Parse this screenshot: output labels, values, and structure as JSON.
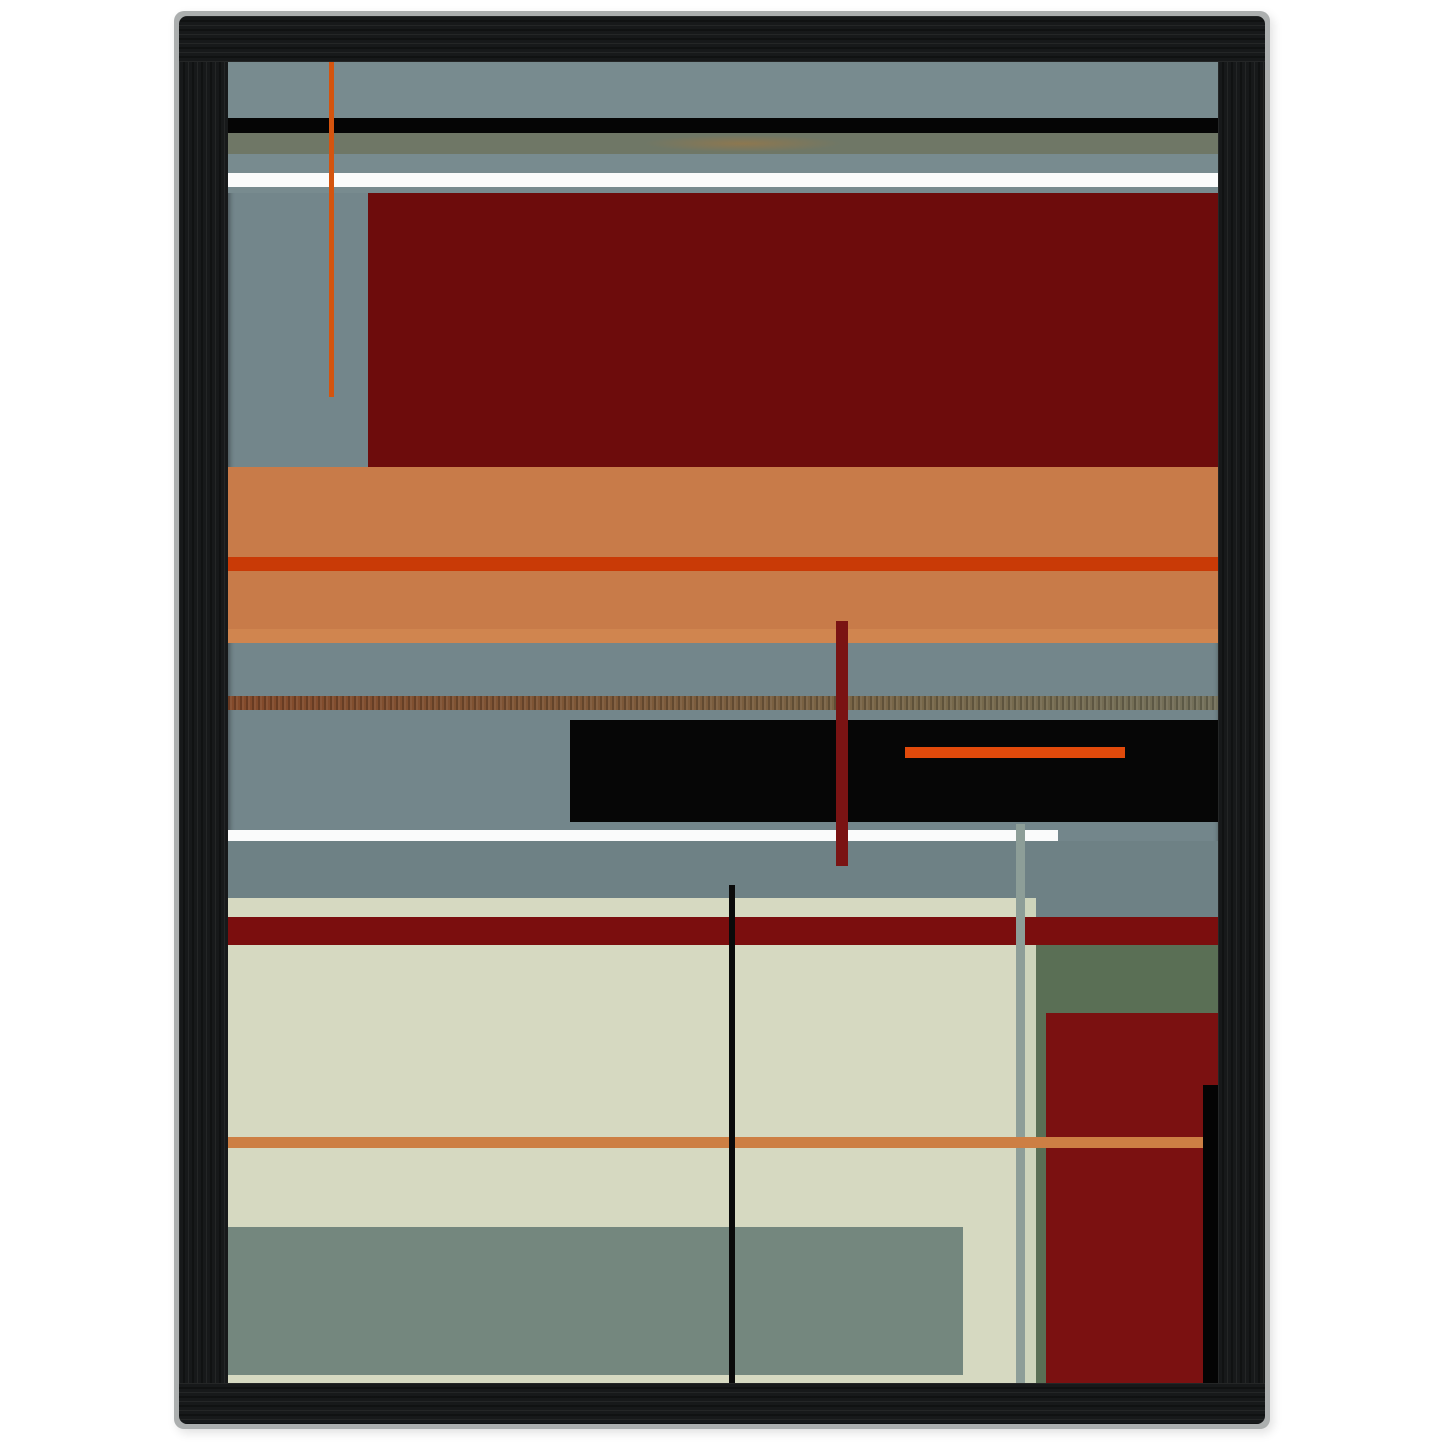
{
  "scene": {
    "background_color": "#ffffff"
  },
  "frame": {
    "rim": {
      "x": 174,
      "y": 11,
      "w": 1096,
      "h": 1418,
      "color": "#acafaf",
      "radius": 10
    },
    "wood": {
      "x": 179,
      "y": 16,
      "w": 1086,
      "h": 1408,
      "color": "#17191a",
      "radius": 8
    },
    "opening": {
      "x": 228,
      "y": 62,
      "w": 990,
      "h": 1321
    }
  },
  "artwork": {
    "base_color": "#73868b",
    "shapes": [
      {
        "name": "gray-top-area",
        "x": 0,
        "y": 0,
        "w": 990,
        "h": 131,
        "bg": "#788b8f"
      },
      {
        "name": "black-stripe-top",
        "x": 0,
        "y": 56,
        "w": 990,
        "h": 15,
        "bg": "#050505"
      },
      {
        "name": "olive-stripe",
        "x": 0,
        "y": 71,
        "w": 990,
        "h": 21,
        "bg": "radial-gradient(ellipse 140px 12px at 52% 50%, rgba(190,120,42,0.38), rgba(190,120,42,0) 70%), #6f7766"
      },
      {
        "name": "white-stripe-top",
        "x": 0,
        "y": 111,
        "w": 990,
        "h": 14,
        "bg": "#fafbfb"
      },
      {
        "name": "dark-red-rect-top",
        "x": 140,
        "y": 131,
        "w": 850,
        "h": 274,
        "bg": "#6d0c0c"
      },
      {
        "name": "orange-band",
        "x": 0,
        "y": 405,
        "w": 990,
        "h": 176,
        "bg": "#c87b49"
      },
      {
        "name": "orange-band-red-stripe",
        "x": 0,
        "y": 495,
        "w": 990,
        "h": 14,
        "bg": "#c93a06"
      },
      {
        "name": "orange-band-light-strip",
        "x": 0,
        "y": 567,
        "w": 990,
        "h": 14,
        "bg": "#d0854f"
      },
      {
        "name": "textured-brown-stripe",
        "x": 0,
        "y": 634,
        "w": 990,
        "h": 14,
        "bg": "repeating-linear-gradient(90deg, rgba(0,0,0,0.20) 0px, rgba(0,0,0,0.20) 2px, rgba(255,255,255,0.06) 2px, rgba(255,255,255,0.06) 4px, rgba(0,0,0,0) 4px, rgba(0,0,0,0) 6px), linear-gradient(90deg, #83492a 0%, #7d5636 35%, #776749 70%, #73705a 100%)"
      },
      {
        "name": "black-rect-middle",
        "x": 342,
        "y": 658,
        "w": 648,
        "h": 102,
        "bg": "#060606"
      },
      {
        "name": "orange-red-bar",
        "x": 677,
        "y": 685,
        "w": 220,
        "h": 11,
        "bg": "#e14a0b"
      },
      {
        "name": "white-stripe-middle",
        "x": 0,
        "y": 768,
        "w": 830,
        "h": 11,
        "bg": "#fafbfb"
      },
      {
        "name": "gray-band-lower",
        "x": 0,
        "y": 779,
        "w": 990,
        "h": 76,
        "bg": "#6e8185"
      },
      {
        "name": "cream-block",
        "x": 0,
        "y": 836,
        "w": 788,
        "h": 485,
        "bg": "#d6d9c1"
      },
      {
        "name": "cream-strip-right",
        "x": 797,
        "y": 836,
        "w": 11,
        "h": 485,
        "bg": "#cdd4bb"
      },
      {
        "name": "olive-green-region",
        "x": 808,
        "y": 883,
        "w": 182,
        "h": 68,
        "bg": "#5a6f55"
      },
      {
        "name": "olive-green-strip",
        "x": 808,
        "y": 951,
        "w": 10,
        "h": 370,
        "bg": "#5a6f55"
      },
      {
        "name": "dark-red-block-bottom",
        "x": 818,
        "y": 951,
        "w": 172,
        "h": 370,
        "bg": "#7b1111"
      },
      {
        "name": "black-strip-right",
        "x": 975,
        "y": 1023,
        "w": 15,
        "h": 298,
        "bg": "#040404"
      },
      {
        "name": "dark-red-band",
        "x": 0,
        "y": 855,
        "w": 990,
        "h": 28,
        "bg": "#7b0e0e"
      },
      {
        "name": "sage-block-bottom",
        "x": 0,
        "y": 1165,
        "w": 735,
        "h": 148,
        "bg": "#74877e"
      },
      {
        "name": "sage-vertical-line",
        "x": 788,
        "y": 762,
        "w": 9,
        "h": 559,
        "bg": "#8d9e98"
      },
      {
        "name": "orange-line-bottom",
        "x": 0,
        "y": 1075,
        "w": 975,
        "h": 11,
        "bg": "#cd7f44"
      },
      {
        "name": "black-vertical-line",
        "x": 501,
        "y": 823,
        "w": 6,
        "h": 498,
        "bg": "#0a0a0a"
      },
      {
        "name": "dark-red-vertical-bar",
        "x": 608,
        "y": 559,
        "w": 12,
        "h": 245,
        "bg": "#7a1313"
      },
      {
        "name": "orange-vertical-line",
        "x": 101,
        "y": 0,
        "w": 5,
        "h": 335,
        "bg": "#d4540e"
      }
    ]
  }
}
